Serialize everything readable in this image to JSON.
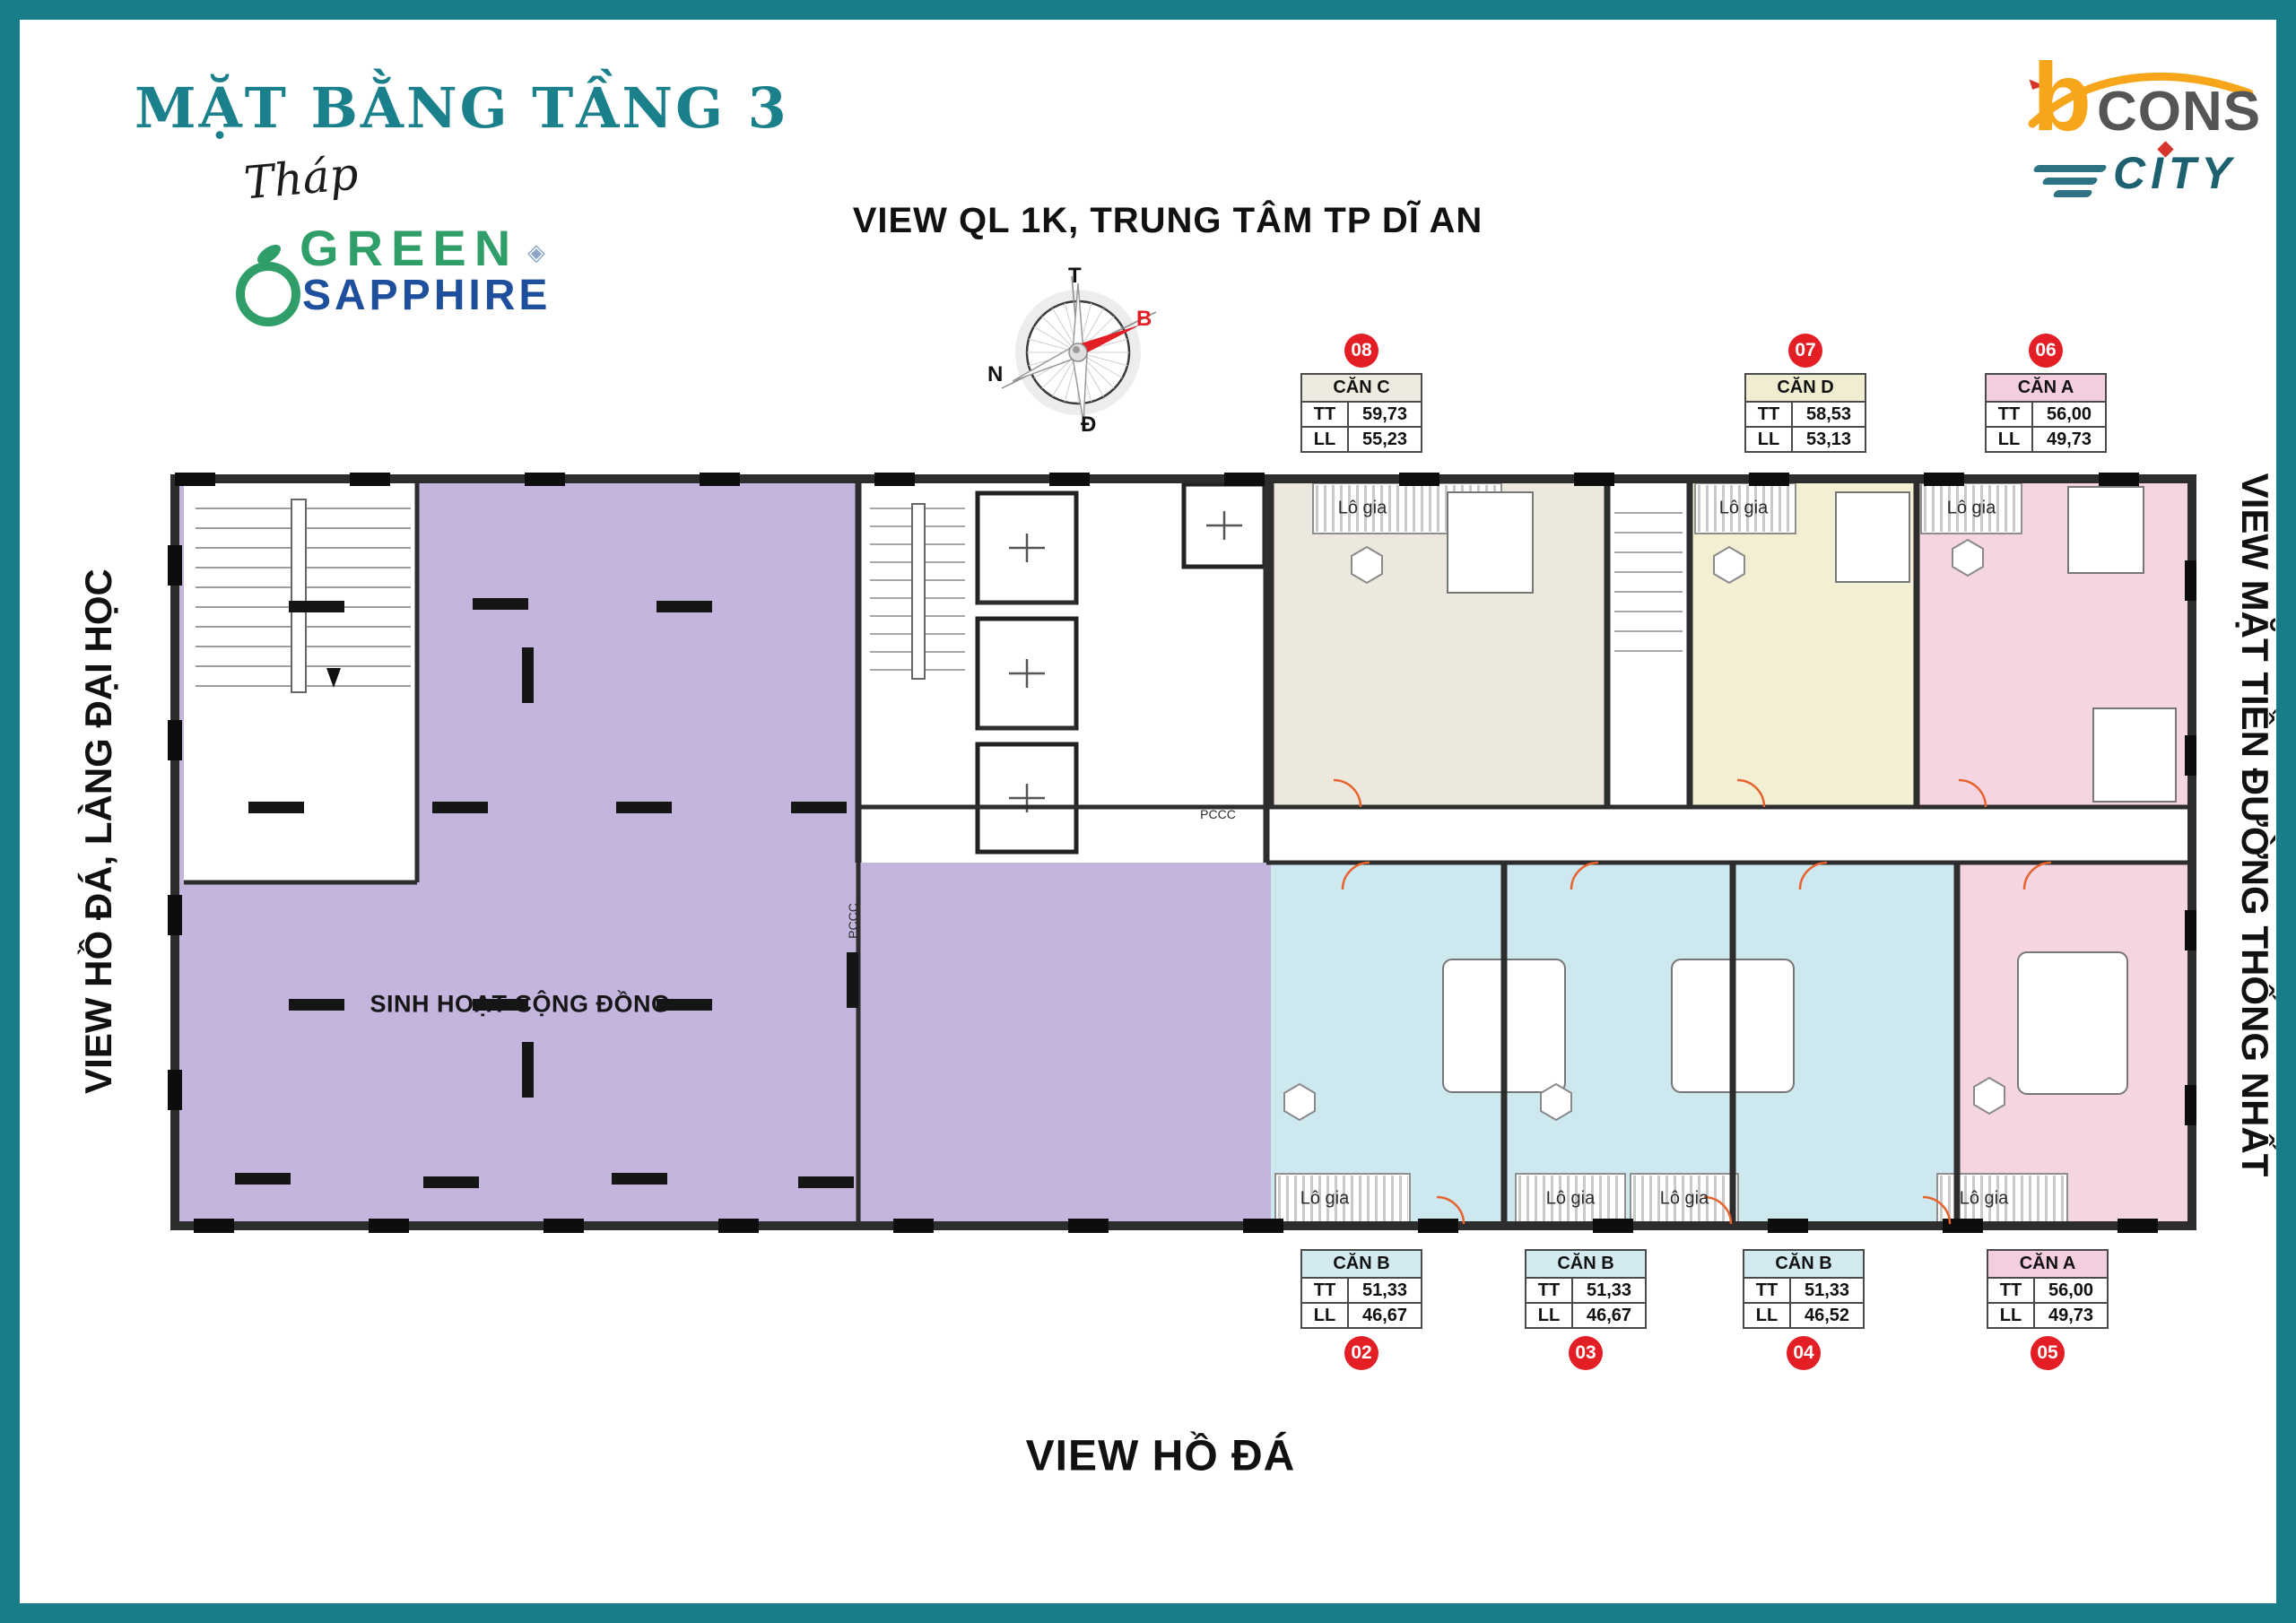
{
  "header": {
    "title": "MẶT BẰNG TẦNG 3",
    "tower_script": "Tháp",
    "brand": {
      "green": "GREEN",
      "sapphire": "SAPPHIRE"
    },
    "developer": {
      "b": "b",
      "cons": "CONS",
      "city": "CITY"
    }
  },
  "views": {
    "top": "VIEW QL 1K, TRUNG TÂM TP DĨ AN",
    "left": "VIEW HỒ ĐÁ, LÀNG ĐẠI HỌC",
    "right": "VIEW MẶT TIỀN ĐƯỜNG THỐNG NHẤT",
    "bottom": "VIEW HỒ ĐÁ"
  },
  "compass": {
    "top": "T",
    "right": "B",
    "left": "N",
    "bottom": "Đ"
  },
  "area_rows": {
    "tt": "TT",
    "ll": "LL"
  },
  "units": [
    {
      "number": "08",
      "name": "CĂN C",
      "tt": "59,73",
      "ll": "55,23"
    },
    {
      "number": "07",
      "name": "CĂN D",
      "tt": "58,53",
      "ll": "53,13"
    },
    {
      "number": "06",
      "name": "CĂN A",
      "tt": "56,00",
      "ll": "49,73"
    },
    {
      "number": "02",
      "name": "CĂN B",
      "tt": "51,33",
      "ll": "46,67"
    },
    {
      "number": "03",
      "name": "CĂN B",
      "tt": "51,33",
      "ll": "46,67"
    },
    {
      "number": "04",
      "name": "CĂN B",
      "tt": "51,33",
      "ll": "46,52"
    },
    {
      "number": "05",
      "name": "CĂN A",
      "tt": "56,00",
      "ll": "49,73"
    }
  ],
  "plan": {
    "community_area": "SINH HOẠT CỘNG ĐỒNG",
    "loggia": "Lô gia",
    "fire_label": "PCCC"
  },
  "icons": {
    "gem": "◈"
  },
  "colors": {
    "border_teal": "#177E89",
    "title_teal": "#1A808C",
    "community_purple": "#C4B5DF",
    "unit_c_beige": "#ECE8DD",
    "unit_d_yellow": "#F2EFD3",
    "unit_a_pink": "#F6D5E3",
    "unit_b_blue": "#CEE8EF",
    "badge_red": "#E31E24",
    "brand_green": "#2F9E68",
    "brand_blue": "#1E4F9C",
    "bcons_orange": "#F7A61B"
  }
}
